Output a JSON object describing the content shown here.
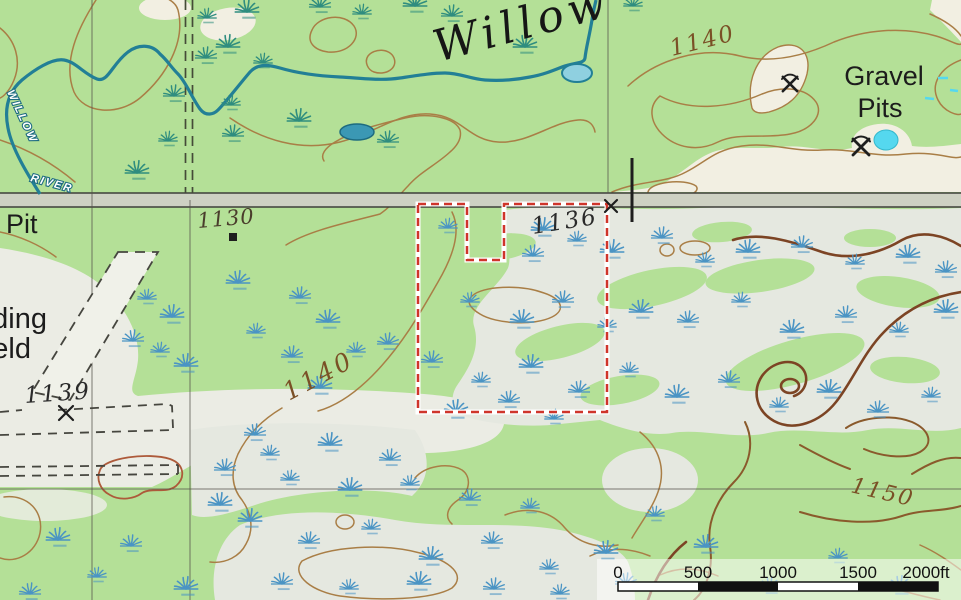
{
  "map": {
    "labels": {
      "river_main": "Willow",
      "river_small_1": "WILLOW",
      "river_small_2": "RIVER",
      "gravel_pits_line1": "Gravel",
      "gravel_pits_line2": "Pits",
      "pit_partial": "Pit",
      "field_partial_1": "ding",
      "field_partial_2": "eld"
    },
    "elevations": {
      "contour_1140_top": "1140",
      "spot_1130": "1130",
      "spot_1136": "1136",
      "spot_1139": "1139",
      "contour_1140_mid": "1140",
      "contour_1150": "1150"
    },
    "icons": {
      "gravel_pit_icon": "crossed-pickaxes",
      "building_icon": "black-square",
      "survey_x_icon": "x-mark",
      "marsh_icon": "swamp-tuft"
    },
    "colors": {
      "bg_green": "#b4e097",
      "wetland_gray": "#e5e8e0",
      "field_gray": "#ebece4",
      "open_tan": "#f2efe2",
      "contour_brown": "#a97e46",
      "contour_index": "#7c4424",
      "water_teal": "#227f96",
      "pond_fill": "#8fd0e0",
      "pond_cyan": "#55d8ef",
      "marsh_upper_teal": "#2f8d7f",
      "marsh_lower_blue": "#4a94c4",
      "boundary_red": "#cf352b",
      "road_gray": "#ced1c3"
    },
    "marsh_tufts_upper": [
      [
        207,
        18
      ],
      [
        247,
        12
      ],
      [
        320,
        7
      ],
      [
        362,
        14
      ],
      [
        415,
        6
      ],
      [
        452,
        16
      ],
      [
        633,
        6
      ],
      [
        228,
        47
      ],
      [
        206,
        58
      ],
      [
        263,
        63
      ],
      [
        525,
        47
      ],
      [
        174,
        96
      ],
      [
        231,
        105
      ],
      [
        299,
        121
      ],
      [
        233,
        136
      ],
      [
        168,
        141
      ],
      [
        137,
        173
      ],
      [
        388,
        142
      ]
    ],
    "marsh_tufts_lower": [
      [
        448,
        228
      ],
      [
        543,
        230
      ],
      [
        533,
        256
      ],
      [
        577,
        241
      ],
      [
        612,
        252
      ],
      [
        662,
        238
      ],
      [
        705,
        262
      ],
      [
        748,
        252
      ],
      [
        802,
        247
      ],
      [
        855,
        264
      ],
      [
        908,
        257
      ],
      [
        946,
        272
      ],
      [
        470,
        302
      ],
      [
        522,
        322
      ],
      [
        563,
        302
      ],
      [
        607,
        327
      ],
      [
        641,
        312
      ],
      [
        688,
        322
      ],
      [
        741,
        302
      ],
      [
        792,
        332
      ],
      [
        846,
        317
      ],
      [
        899,
        332
      ],
      [
        946,
        312
      ],
      [
        432,
        362
      ],
      [
        481,
        382
      ],
      [
        531,
        367
      ],
      [
        579,
        392
      ],
      [
        629,
        372
      ],
      [
        677,
        397
      ],
      [
        729,
        382
      ],
      [
        779,
        407
      ],
      [
        829,
        392
      ],
      [
        878,
        412
      ],
      [
        931,
        397
      ],
      [
        456,
        412
      ],
      [
        509,
        402
      ],
      [
        554,
        419
      ],
      [
        238,
        283
      ],
      [
        300,
        298
      ],
      [
        256,
        333
      ],
      [
        328,
        322
      ],
      [
        292,
        357
      ],
      [
        356,
        352
      ],
      [
        320,
        388
      ],
      [
        388,
        344
      ],
      [
        147,
        299
      ],
      [
        172,
        317
      ],
      [
        133,
        341
      ],
      [
        160,
        352
      ],
      [
        186,
        366
      ],
      [
        225,
        470
      ],
      [
        270,
        455
      ],
      [
        330,
        445
      ],
      [
        390,
        460
      ],
      [
        290,
        480
      ],
      [
        350,
        490
      ],
      [
        255,
        435
      ],
      [
        410,
        485
      ],
      [
        220,
        505
      ],
      [
        470,
        500
      ],
      [
        530,
        508
      ],
      [
        250,
        521
      ],
      [
        309,
        543
      ],
      [
        371,
        529
      ],
      [
        431,
        559
      ],
      [
        492,
        543
      ],
      [
        549,
        569
      ],
      [
        606,
        553
      ],
      [
        282,
        584
      ],
      [
        349,
        589
      ],
      [
        419,
        584
      ],
      [
        494,
        589
      ],
      [
        560,
        594
      ],
      [
        58,
        540
      ],
      [
        131,
        546
      ],
      [
        97,
        577
      ],
      [
        186,
        589
      ],
      [
        30,
        594
      ],
      [
        655,
        516
      ],
      [
        706,
        547
      ],
      [
        770,
        588
      ],
      [
        838,
        558
      ],
      [
        900,
        588
      ],
      [
        626,
        584
      ]
    ],
    "cyan_dashes": [
      [
        938,
        78,
        948,
        78
      ],
      [
        950,
        90,
        958,
        91
      ],
      [
        925,
        98,
        934,
        99
      ]
    ]
  },
  "scalebar": {
    "labels": [
      "0",
      "500",
      "1000",
      "1500",
      "2000ft"
    ],
    "units": "feet",
    "total": "2000"
  }
}
